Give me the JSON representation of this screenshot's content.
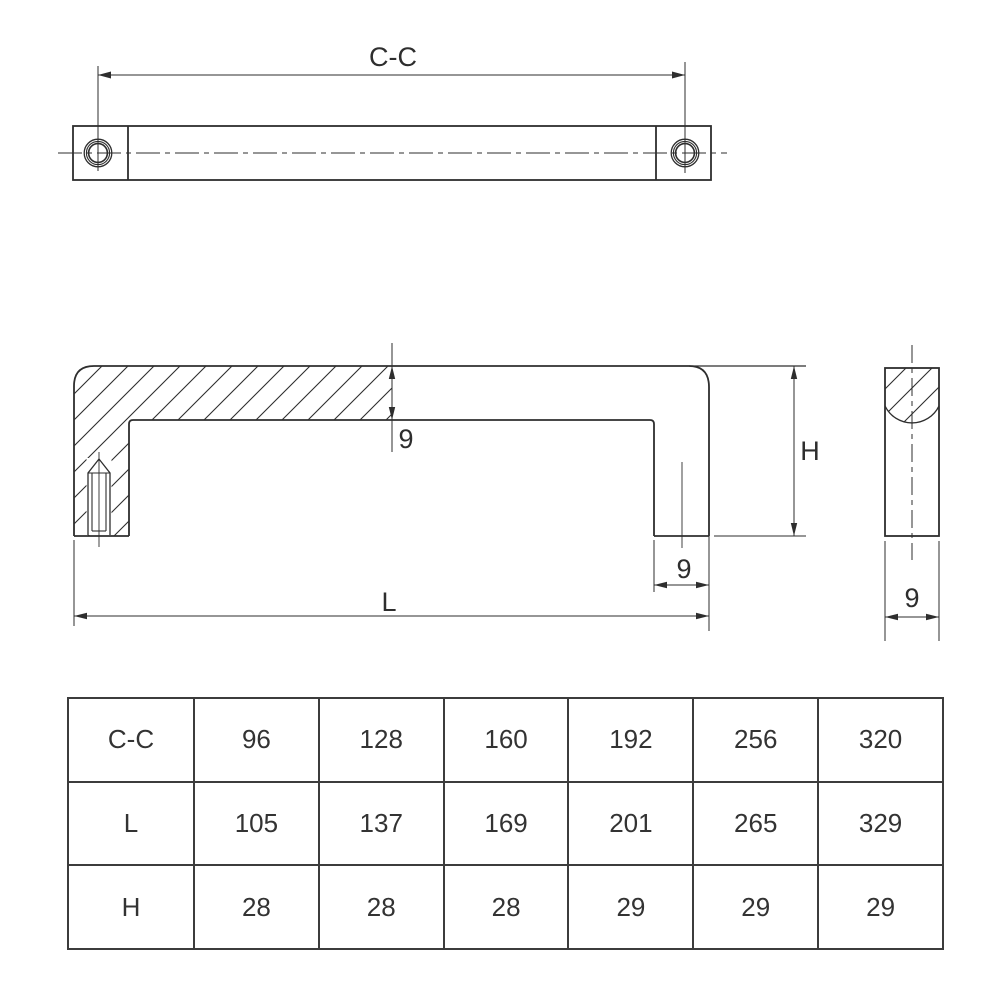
{
  "colors": {
    "line": "#2e2e2e",
    "background": "#ffffff",
    "table_border": "#3c3c3c",
    "text": "#333333"
  },
  "views": {
    "top": {
      "dim_cc_label": "C-C"
    },
    "front": {
      "thickness_label": "9",
      "height_label": "H",
      "length_label": "L",
      "leg_width_label": "9"
    },
    "side": {
      "width_label": "9"
    }
  },
  "spec_table": {
    "rows": [
      {
        "label": "C-C",
        "values": [
          "96",
          "128",
          "160",
          "192",
          "256",
          "320"
        ]
      },
      {
        "label": "L",
        "values": [
          "105",
          "137",
          "169",
          "201",
          "265",
          "329"
        ]
      },
      {
        "label": "H",
        "values": [
          "28",
          "28",
          "28",
          "29",
          "29",
          "29"
        ]
      }
    ]
  }
}
